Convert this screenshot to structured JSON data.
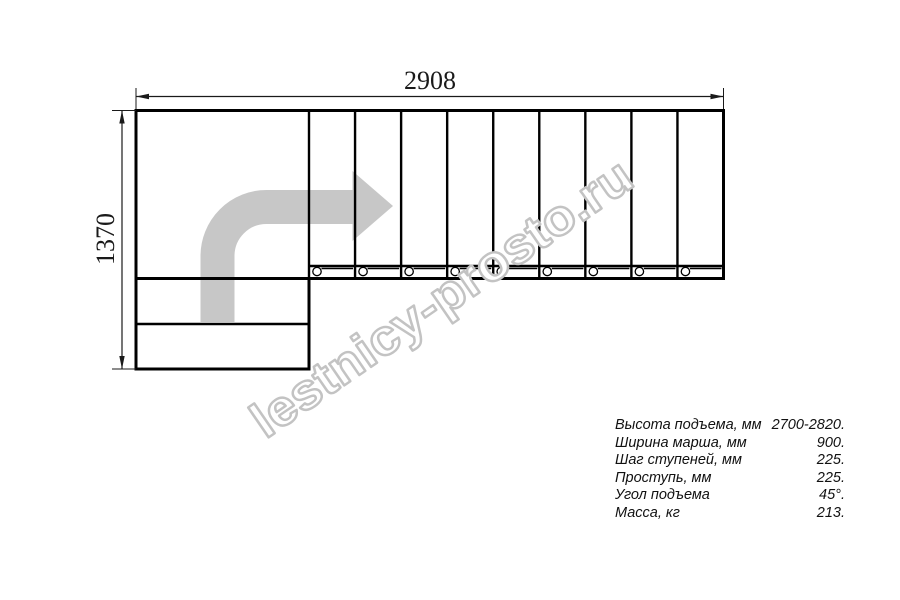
{
  "drawing": {
    "dim_width": "2908",
    "dim_height": "1370",
    "watermark": "lestnicy-prosto.ru",
    "flight_steps": 9,
    "lower_steps": 2,
    "colors": {
      "line": "#000000",
      "arrow": "#c7c7c7",
      "watermark_stroke": "#c3c3c3"
    }
  },
  "specs": {
    "rows": [
      {
        "label": "Высота подъема, мм",
        "value": "2700-2820."
      },
      {
        "label": "Ширина марша, мм",
        "value": "900."
      },
      {
        "label": "Шаг ступеней, мм",
        "value": "225."
      },
      {
        "label": "Проступь, мм",
        "value": "225."
      },
      {
        "label": "Угол подъема",
        "value": "45°."
      },
      {
        "label": "Масса, кг",
        "value": "213."
      }
    ]
  }
}
